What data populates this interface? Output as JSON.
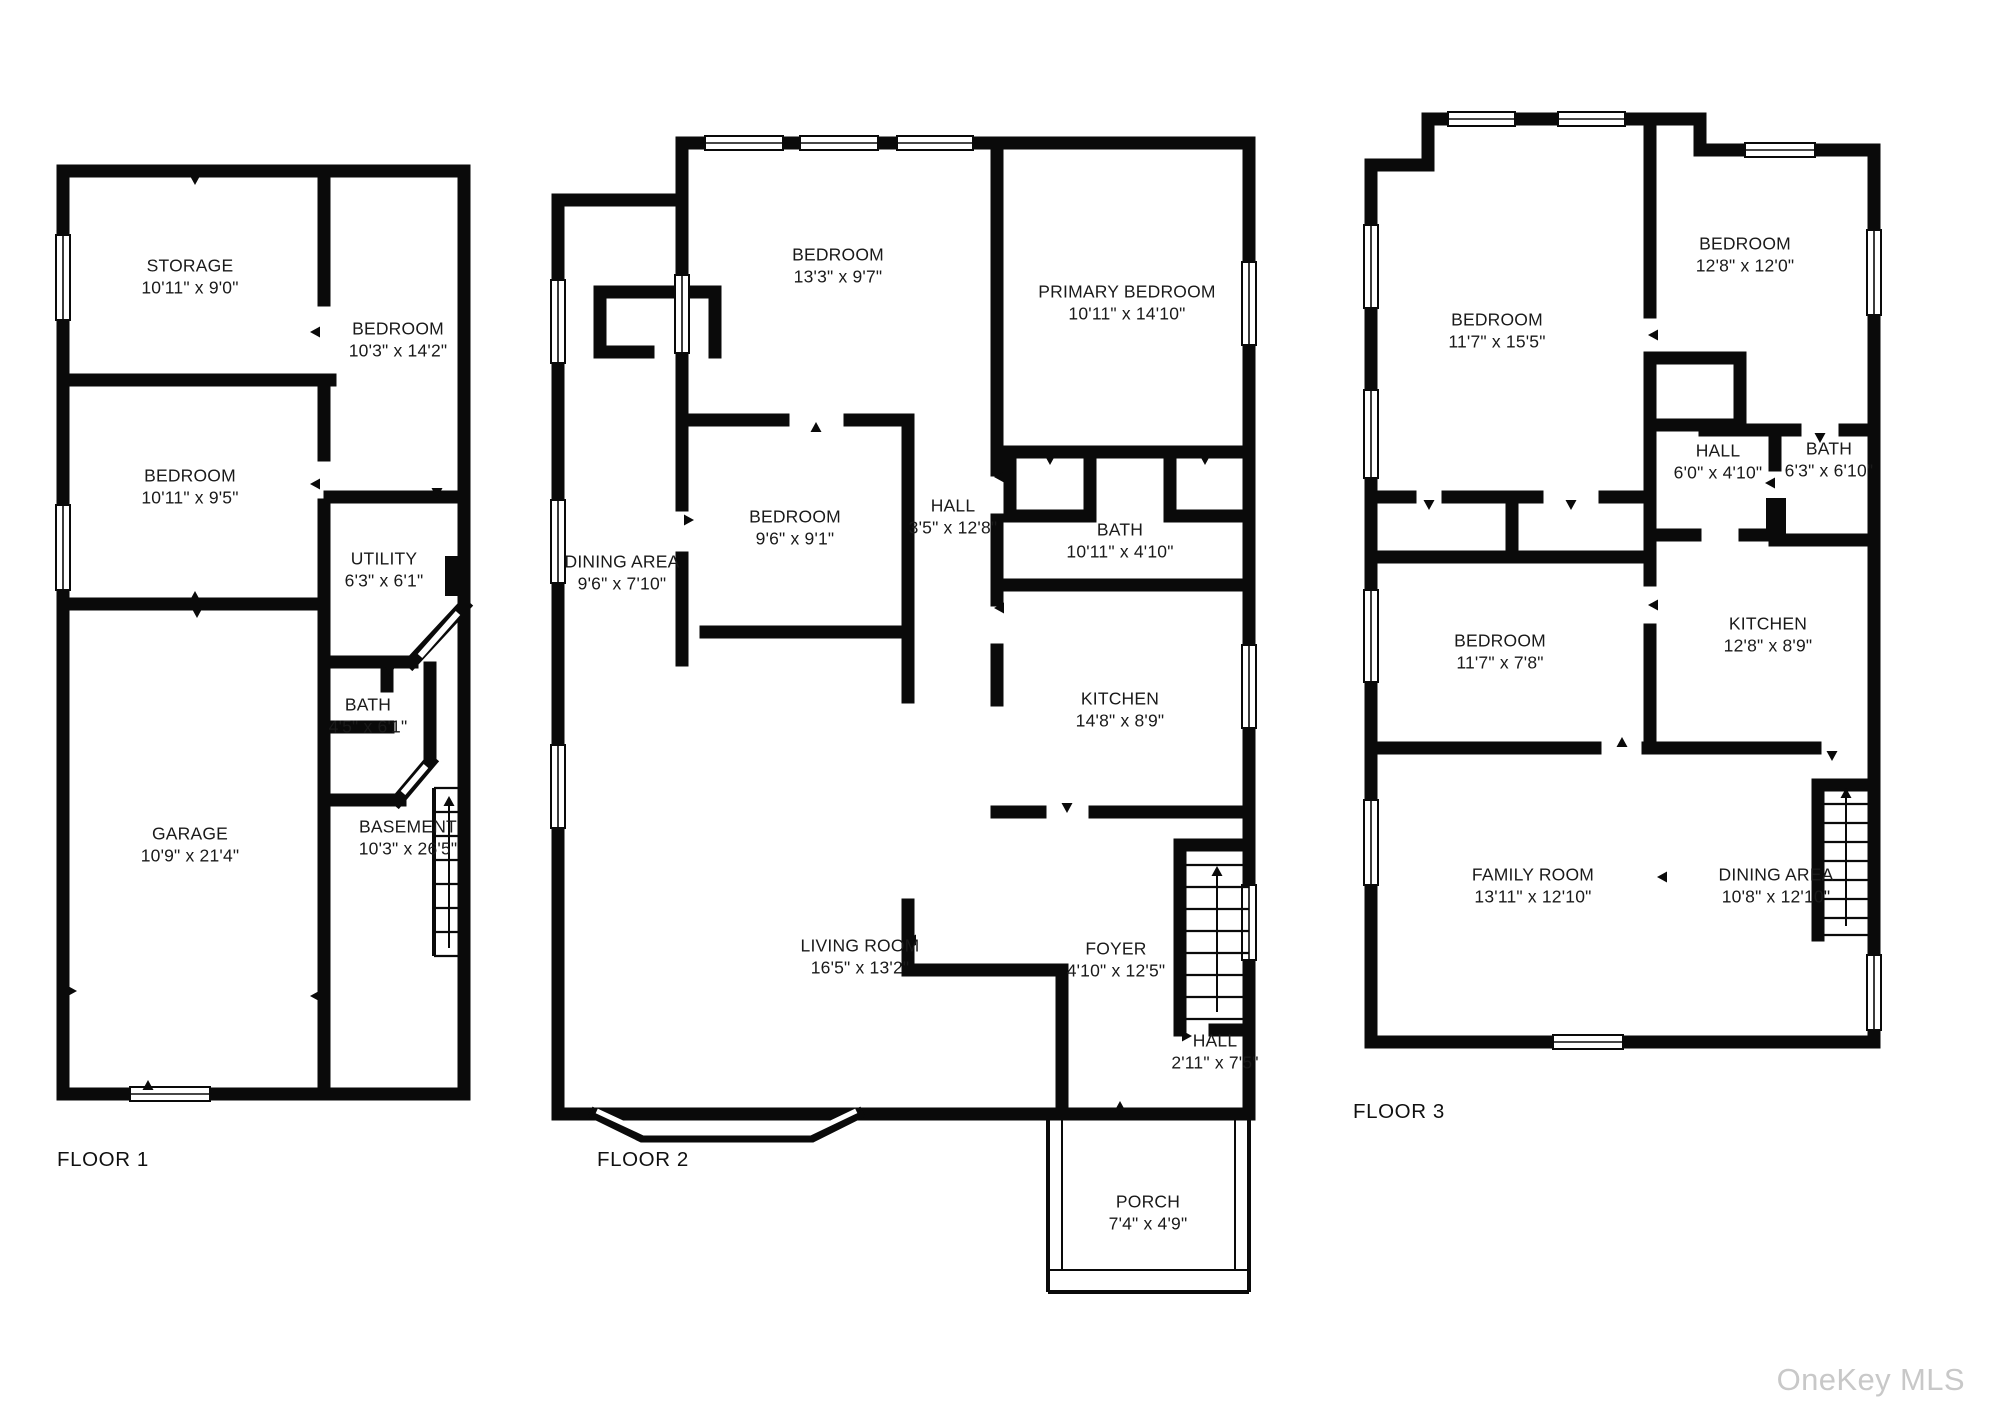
{
  "watermark": "OneKey MLS",
  "floors": [
    {
      "label": "FLOOR 1",
      "rooms": [
        {
          "name": "STORAGE",
          "dims": "10'11\" x 9'0\""
        },
        {
          "name": "BEDROOM",
          "dims": "10'3\" x 14'2\""
        },
        {
          "name": "BEDROOM",
          "dims": "10'11\" x 9'5\""
        },
        {
          "name": "UTILITY",
          "dims": "6'3\" x 6'1\""
        },
        {
          "name": "BATH",
          "dims": "4'5\" x 6'1\""
        },
        {
          "name": "GARAGE",
          "dims": "10'9\" x 21'4\""
        },
        {
          "name": "BASEMENT",
          "dims": "10'3\" x 26'5\""
        }
      ]
    },
    {
      "label": "FLOOR 2",
      "rooms": [
        {
          "name": "BEDROOM",
          "dims": "13'3\" x 9'7\""
        },
        {
          "name": "PRIMARY BEDROOM",
          "dims": "10'11\" x 14'10\""
        },
        {
          "name": "BEDROOM",
          "dims": "9'6\" x 9'1\""
        },
        {
          "name": "HALL",
          "dims": "3'5\" x 12'8\""
        },
        {
          "name": "BATH",
          "dims": "10'11\" x 4'10\""
        },
        {
          "name": "KITCHEN",
          "dims": "14'8\" x 8'9\""
        },
        {
          "name": "DINING AREA",
          "dims": "9'6\" x 7'10\""
        },
        {
          "name": "LIVING ROOM",
          "dims": "16'5\" x 13'2\""
        },
        {
          "name": "FOYER",
          "dims": "4'10\" x 12'5\""
        },
        {
          "name": "HALL",
          "dims": "2'11\" x 7'5\""
        },
        {
          "name": "PORCH",
          "dims": "7'4\" x 4'9\""
        }
      ]
    },
    {
      "label": "FLOOR 3",
      "rooms": [
        {
          "name": "BEDROOM",
          "dims": "11'7\" x 15'5\""
        },
        {
          "name": "BEDROOM",
          "dims": "12'8\" x 12'0\""
        },
        {
          "name": "HALL",
          "dims": "6'0\" x 4'10\""
        },
        {
          "name": "BATH",
          "dims": "6'3\" x 6'10\""
        },
        {
          "name": "BEDROOM",
          "dims": "11'7\" x 7'8\""
        },
        {
          "name": "KITCHEN",
          "dims": "12'8\" x 8'9\""
        },
        {
          "name": "FAMILY ROOM",
          "dims": "13'11\" x 12'10\""
        },
        {
          "name": "DINING AREA",
          "dims": "10'8\" x 12'10\""
        }
      ]
    }
  ]
}
